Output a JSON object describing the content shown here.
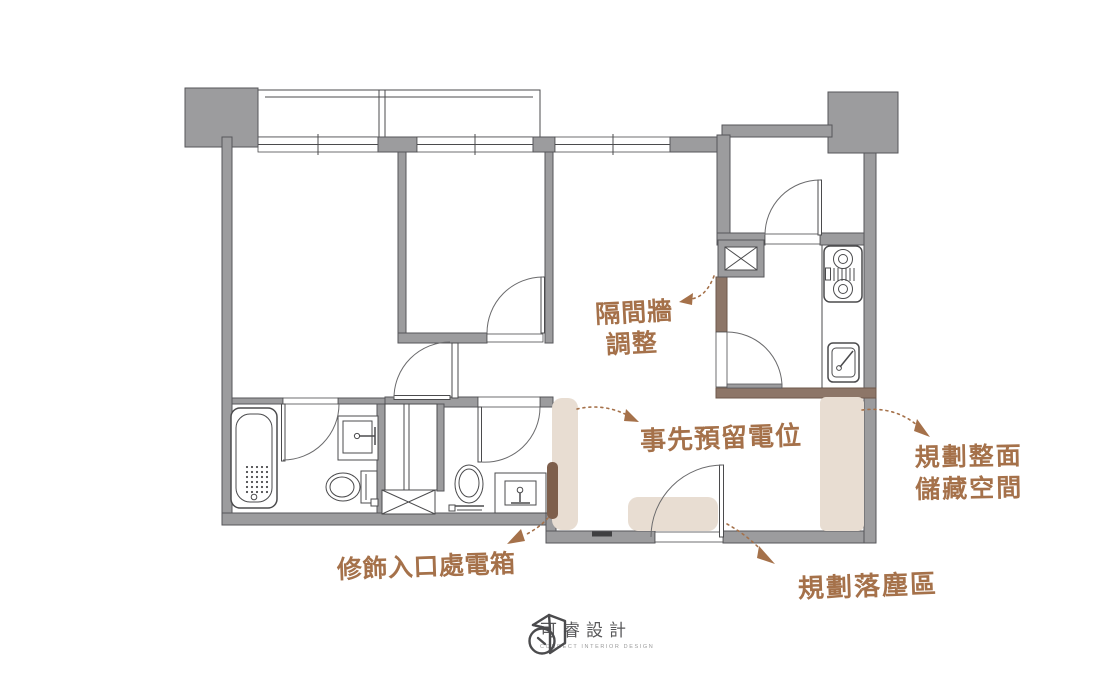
{
  "colors": {
    "wall": "#9c9c9e",
    "wall_outline": "#56565a",
    "wall_brown": "#8d7668",
    "wall_brown_outline": "#6e584b",
    "highlight": "#e8ddd2",
    "highlight_dark": "#7e5f4c",
    "accent": "#a5714a",
    "line": "#4b4b4d",
    "logo_text": "#58585a",
    "logo_tagline": "#9b9b9b"
  },
  "annotations": {
    "partition_wall": {
      "line1": "隔間牆",
      "line2": "調整"
    },
    "reserve_outlet": {
      "text": "事先預留電位"
    },
    "storage": {
      "line1": "規劃整面",
      "line2": "儲藏空間"
    },
    "electrical_box": {
      "text": "修飾入口處電箱"
    },
    "dust_area": {
      "text": "規劃落塵區"
    }
  },
  "logo": {
    "name": "可睿設計",
    "tagline": "CORRECT INTERIOR DESIGN"
  },
  "fixtures": [
    "bathtub",
    "toilet",
    "vanity-sink",
    "wardrobe",
    "duct-shaft",
    "gas-stove",
    "kitchen-sink",
    "entry-door",
    "room-door",
    "window",
    "balcony",
    "pillar"
  ]
}
